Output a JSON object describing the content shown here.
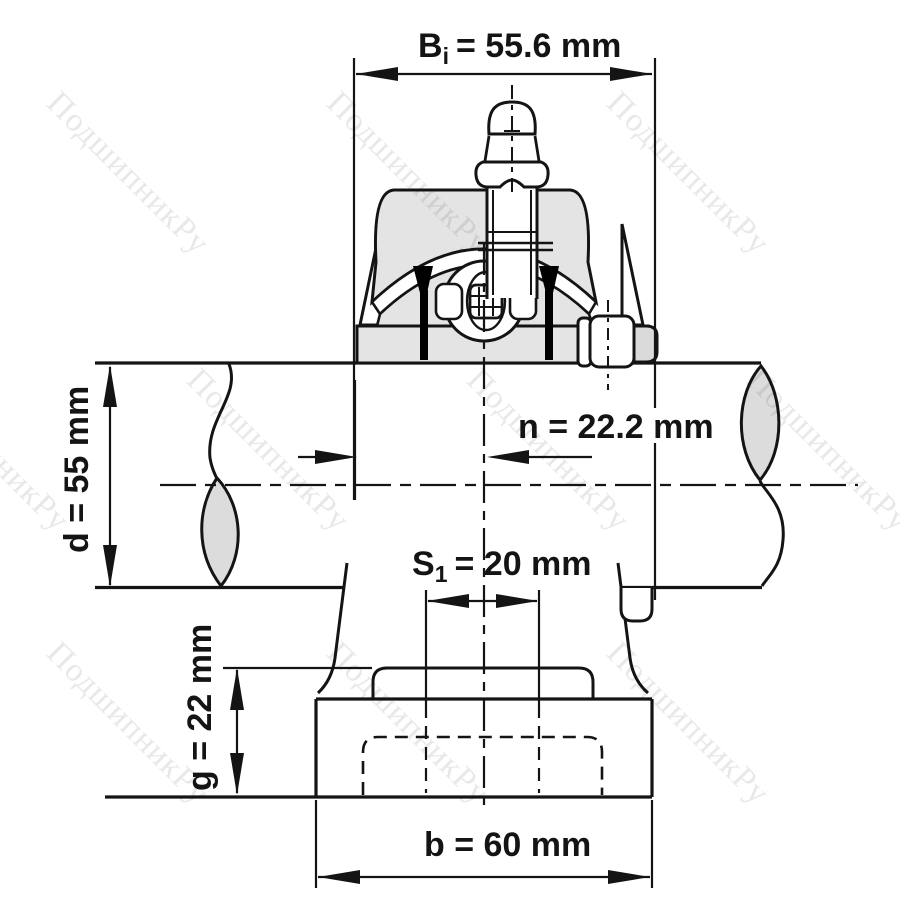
{
  "title_context": "bearing unit dimensional drawing",
  "labels": {
    "Bi_name": "B",
    "Bi_sub": "i",
    "Bi_value": "= 55.6 mm",
    "n": "n = 22.2 mm",
    "d": "d = 55 mm",
    "S1_name": "S",
    "S1_sub": "1",
    "S1_value": "= 20 mm",
    "g": "g = 22 mm",
    "b": "b = 60 mm"
  },
  "dimensions": [
    {
      "symbol": "Bi",
      "value": 55.6,
      "unit": "mm",
      "meaning": "dimension across top"
    },
    {
      "symbol": "n",
      "value": 22.2,
      "unit": "mm",
      "meaning": "horizontal dimension at shaft"
    },
    {
      "symbol": "d",
      "value": 55,
      "unit": "mm",
      "meaning": "shaft diameter"
    },
    {
      "symbol": "S1",
      "value": 20,
      "unit": "mm",
      "meaning": "dimension at pedestal step"
    },
    {
      "symbol": "g",
      "value": 22,
      "unit": "mm",
      "meaning": "base height"
    },
    {
      "symbol": "b",
      "value": 60,
      "unit": "mm",
      "meaning": "base width"
    }
  ],
  "watermark": {
    "text": "ПодшипникРу",
    "color": "#e8e8e8"
  },
  "colors": {
    "line": "#141414",
    "fill_light": "#e4e4e4",
    "fill_mid": "#dcdcdc",
    "background": "#ffffff"
  }
}
